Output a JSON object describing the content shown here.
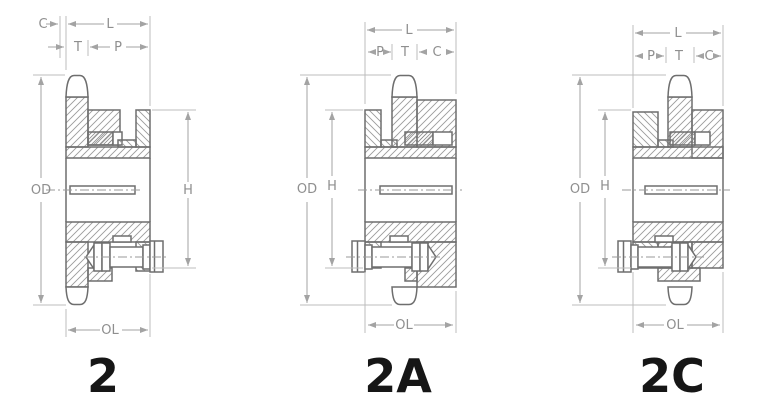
{
  "figure": {
    "type": "technical-diagram",
    "subject": "Double-strand roller chain sprocket hub styles, cross-section views with dimension callouts",
    "background": "#ffffff",
    "colors": {
      "body_outline": "#6e6e6e",
      "hatch_lines": "#9b9b9b",
      "dimension_lines": "#a3a3a3",
      "extension_lines": "#bcbcbc",
      "dimension_text": "#8f8f8f",
      "style_label_text": "#161616"
    },
    "drawings": [
      {
        "label": "2",
        "hub_style": "hub flush left, projection right",
        "dims": {
          "c": "C",
          "l": "L",
          "t": "T",
          "p": "P",
          "od": "OD",
          "h": "H",
          "ol": "OL"
        }
      },
      {
        "label": "2A",
        "hub_style": "hub projection right",
        "dims": {
          "c": "C",
          "l": "L",
          "t": "T",
          "p": "P",
          "od": "OD",
          "h": "H",
          "ol": "OL"
        }
      },
      {
        "label": "2C",
        "hub_style": "hub projection both sides",
        "dims": {
          "c": "C",
          "l": "L",
          "t": "T",
          "p": "P",
          "od": "OD",
          "h": "H",
          "ol": "OL"
        }
      }
    ]
  }
}
